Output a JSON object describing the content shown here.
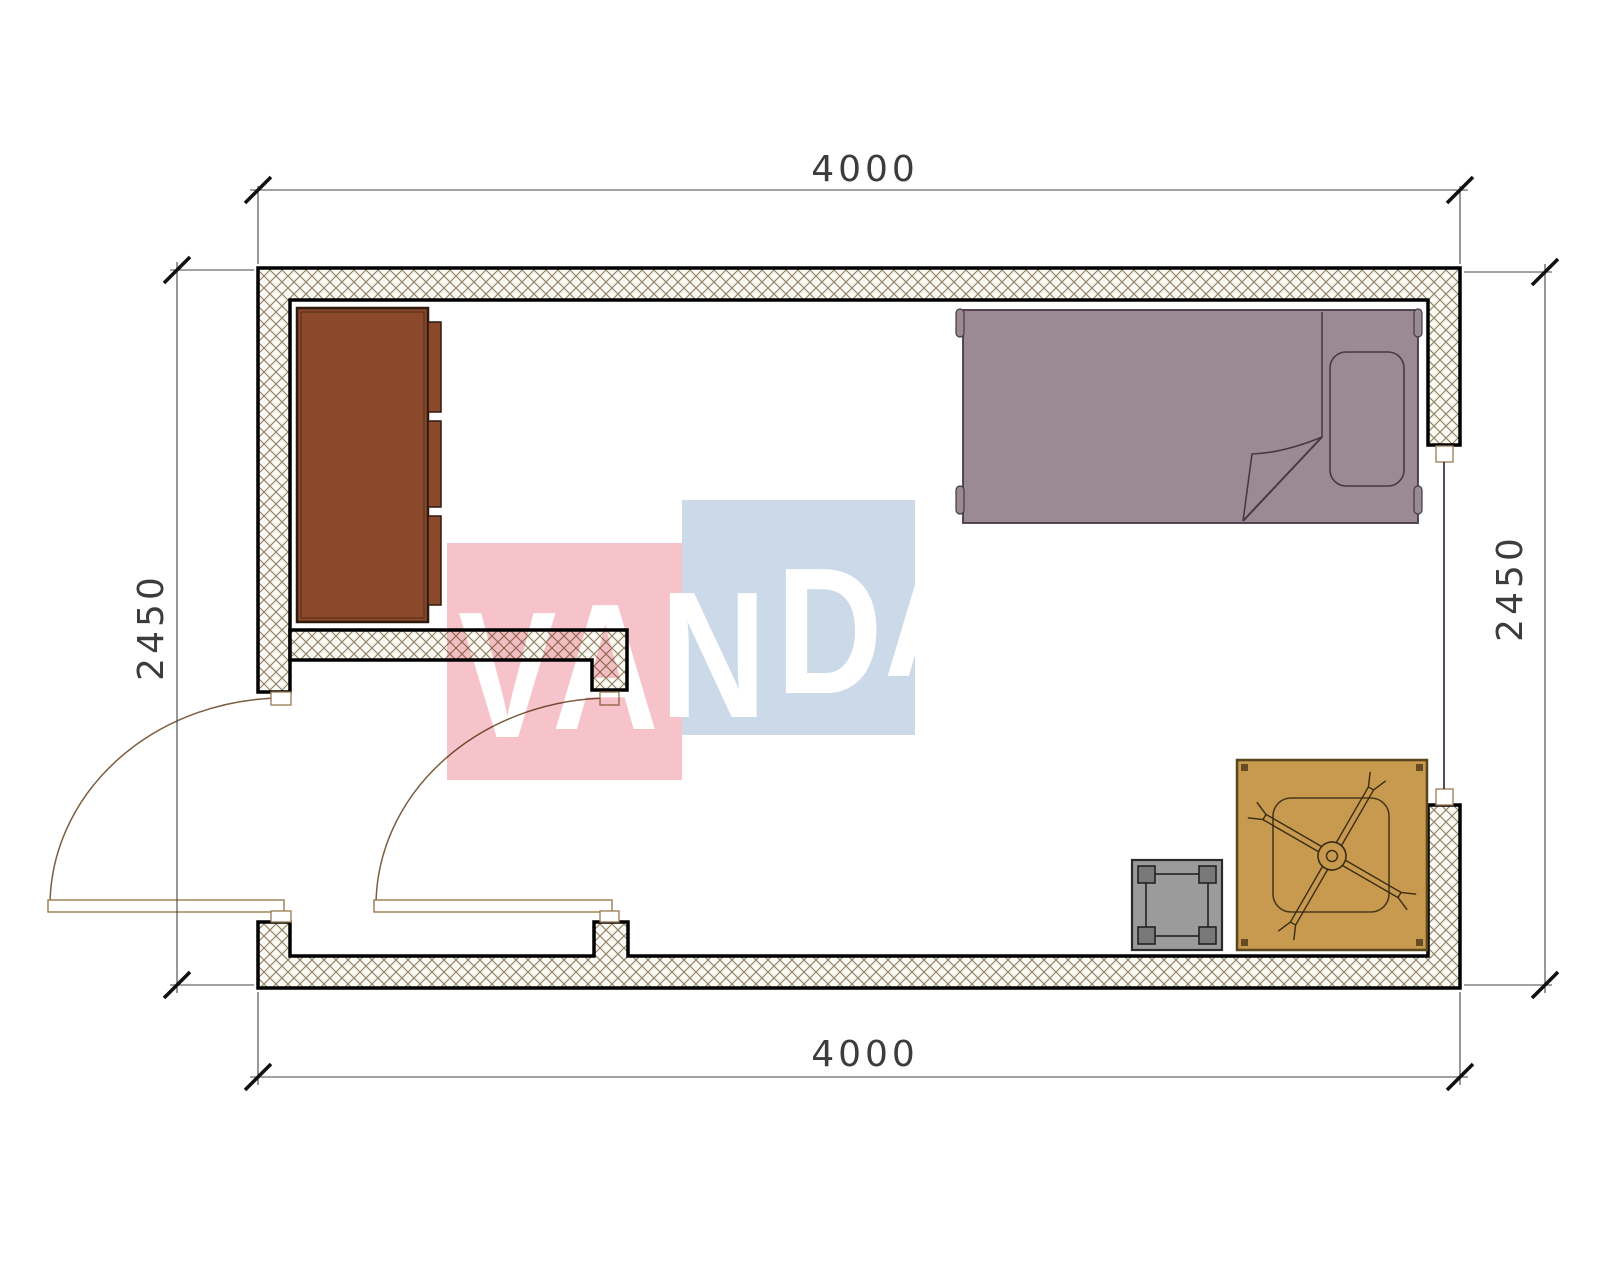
{
  "title": "room-floor-plan",
  "dimensions": {
    "top": "4000",
    "bottom": "4000",
    "left": "2450",
    "right": "2450"
  },
  "watermark": {
    "letters": [
      "V",
      "A",
      "N",
      "D",
      "A"
    ],
    "red_block": "#f6c3cb",
    "blue_block": "#ccd9e9",
    "text_color": "#ffffff"
  },
  "colors": {
    "wall_fill": "#fbf9f3",
    "wall_hatch_line": "#8d7f5f",
    "wall_outline": "#000000",
    "bed": "#9c8a92",
    "bed_outline": "#463844",
    "cabinet": "#8a492b",
    "cabinet_outline": "#2e1a0e",
    "table": "#c79a4f",
    "table_outline": "#5a451e",
    "table_detail": "#3a2c12",
    "stool": "#9b9b9b",
    "stool_leg": "#787878",
    "stool_outline": "#2a2a2a",
    "door_leaf_fill": "#ffffff",
    "door_frame": "#9a7a50",
    "door_arc": "#7b5d3f",
    "window_line": "#222233",
    "dimension": "#3c3c3c",
    "tick": "#111111"
  },
  "furniture": [
    {
      "name": "wardrobe",
      "location": "top-left"
    },
    {
      "name": "single-bed",
      "location": "top-right"
    },
    {
      "name": "low-table-with-fan",
      "location": "bottom-right"
    },
    {
      "name": "stool",
      "location": "bottom-right"
    }
  ],
  "openings": [
    {
      "name": "entry-door-left",
      "type": "swing-door"
    },
    {
      "name": "entry-door-middle",
      "type": "swing-door"
    },
    {
      "name": "window-right-wall",
      "type": "window"
    }
  ]
}
